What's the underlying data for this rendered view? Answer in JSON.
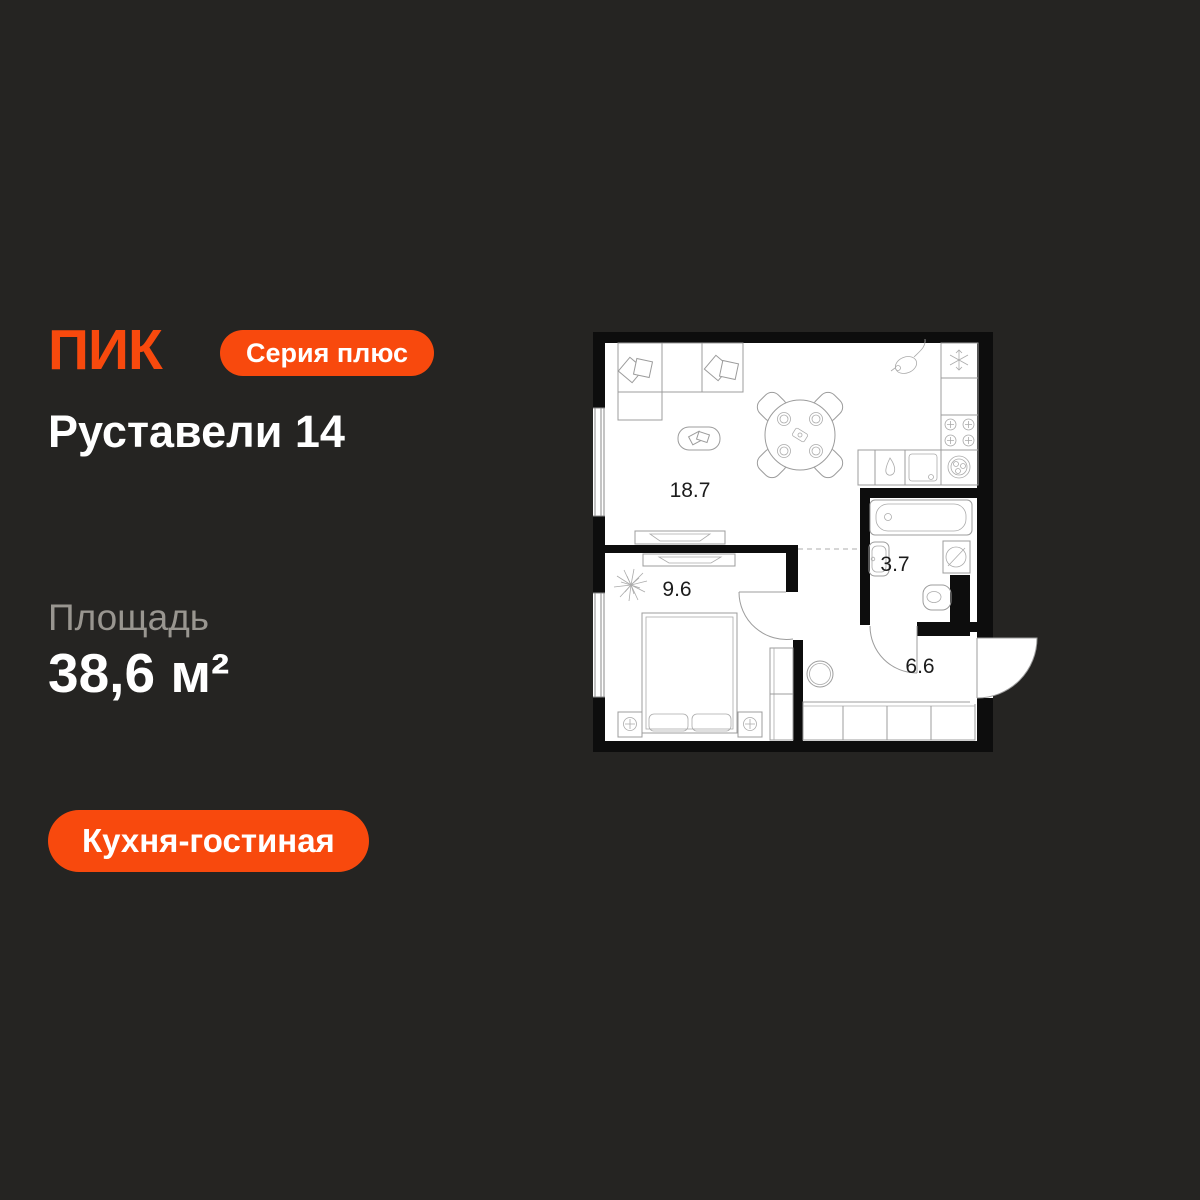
{
  "background": "#252422",
  "brand": {
    "logo_text": "ПИК",
    "logo_color": "#F8490D"
  },
  "series_badge": {
    "label": "Серия плюс",
    "bg": "#F8490D",
    "text_color": "#FFFFFF"
  },
  "project": {
    "title": "Руставели 14"
  },
  "area": {
    "label": "Площадь",
    "value": "38,6 м²"
  },
  "room_tag": {
    "label": "Кухня-гостиная",
    "bg": "#F8490D",
    "text_color": "#FFFFFF"
  },
  "floorplan": {
    "bg": "#FFFFFF",
    "wall_color": "#0D0D0D",
    "furniture_color": "#9C9C9C",
    "rooms": [
      {
        "name": "kitchen-living-room",
        "area": "18.7"
      },
      {
        "name": "bedroom",
        "area": "9.6"
      },
      {
        "name": "bathroom",
        "area": "3.7"
      },
      {
        "name": "hallway",
        "area": "6.6"
      }
    ]
  }
}
